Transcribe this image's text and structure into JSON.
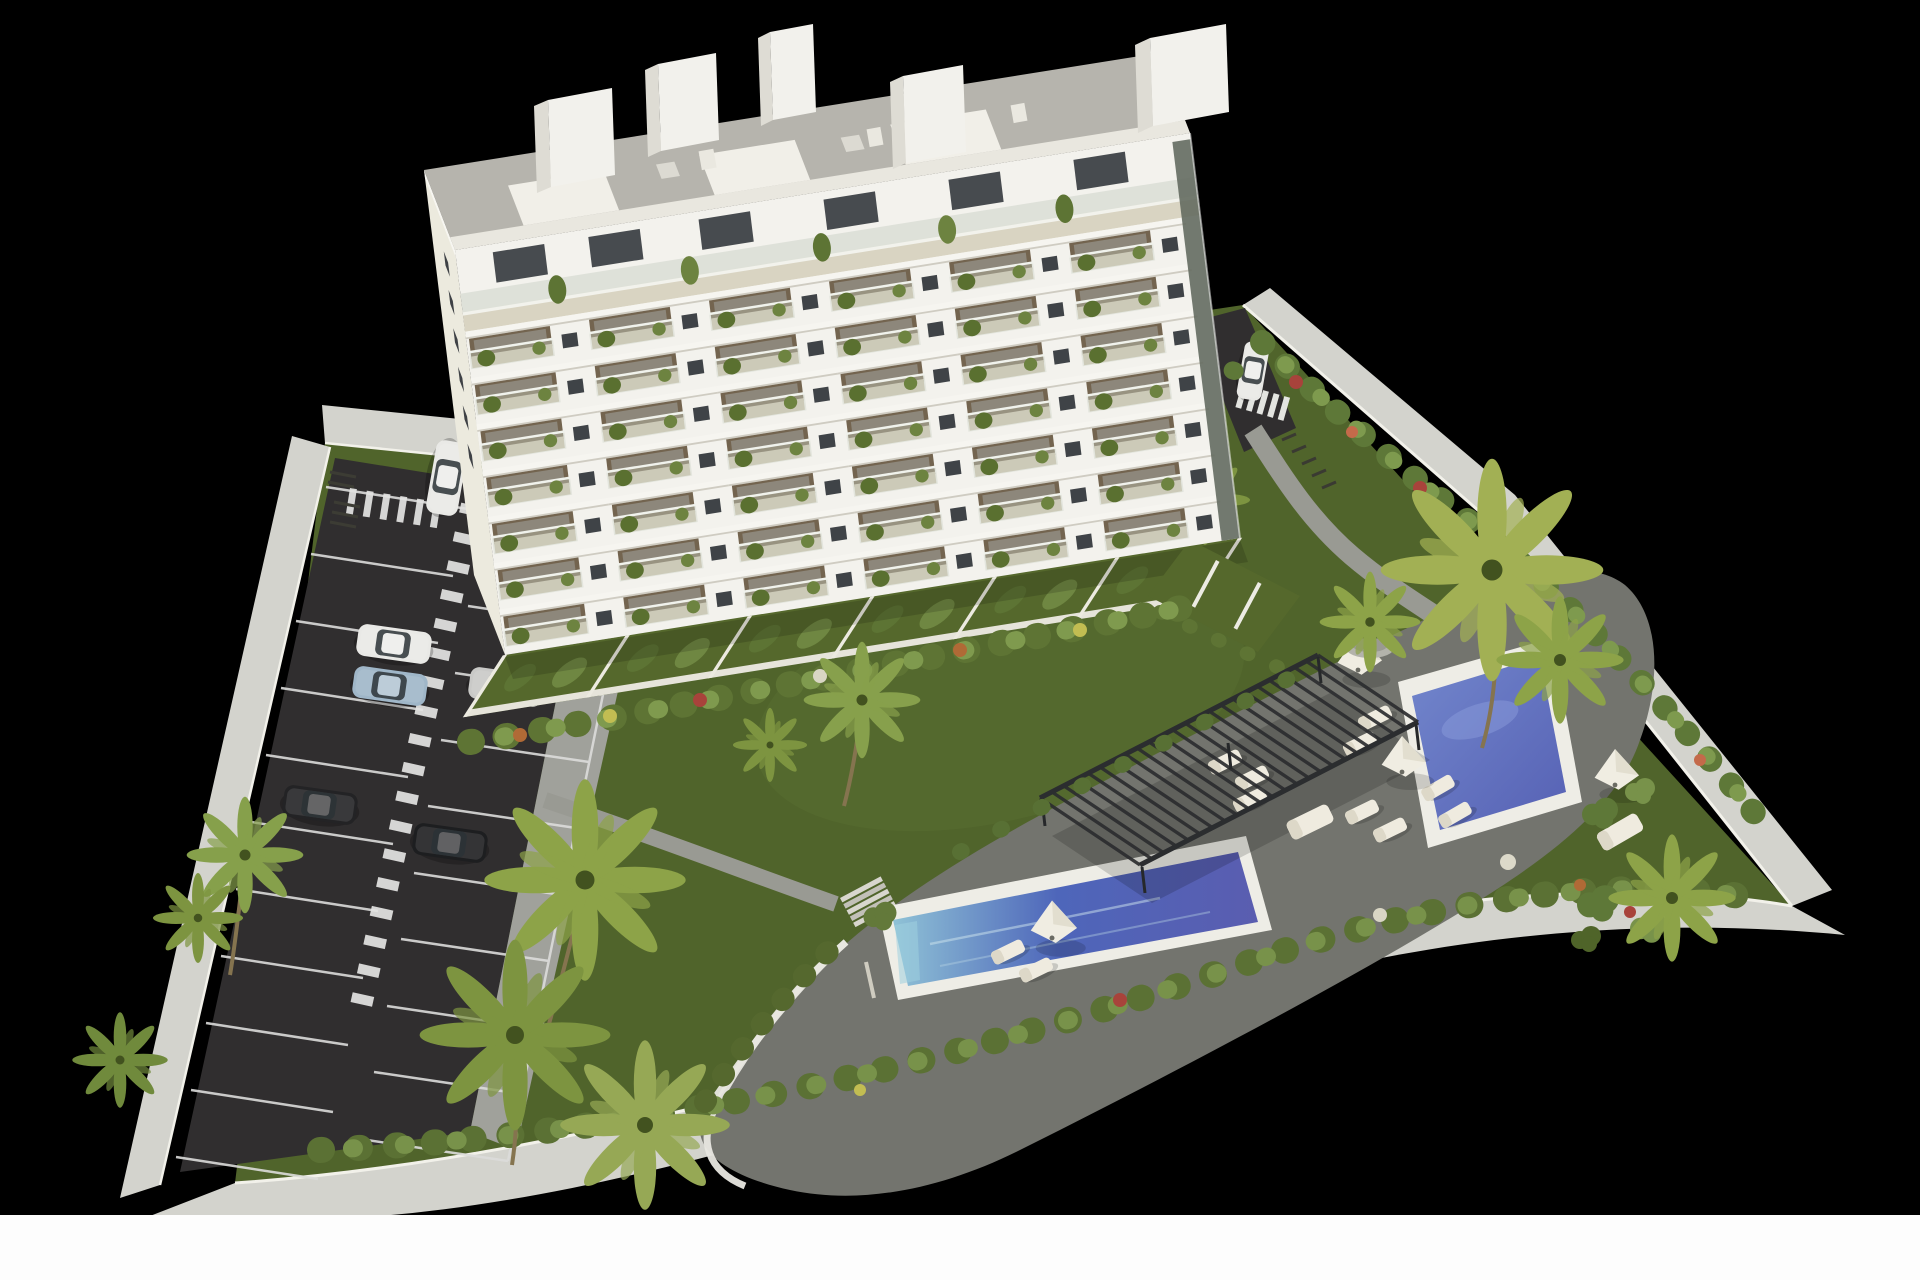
{
  "meta": {
    "type": "3d-architectural-render",
    "description": "Aerial 3D visualization of a white residential apartment block with landscaped gardens, two blue swimming pools, a slatted pergola sun deck and a surface parking lot, isolated on a black background with a white strip at the bottom edge"
  },
  "palette": {
    "background": "#000000",
    "foreground_band": "#fdfdfd",
    "grass": "#50642b",
    "grass_light": "#5d7333",
    "asphalt": "#302e2f",
    "parking_line": "#dcdcda",
    "wall": "#d3d3cd",
    "wall_top": "#f2f1ea",
    "building": "#f3f2ed",
    "building_shadow": "#e2e0d8",
    "roof": "#b6b4ad",
    "balcony_floor": "#cbc3ad",
    "balcony_interior": "#73644f",
    "window": "#3f4347",
    "terrace_wall": "#eceae0",
    "deck": "#73746e",
    "path": "#999a93",
    "pergola": "#2b2d2f",
    "pool_coping": "#eeede6",
    "pool_water_light": "#8fc2d6",
    "pool_water_deep": "#4e66ba",
    "pool_water_violet": "#5a5db0",
    "furniture": "#efebdf",
    "foliage": "#5e7434",
    "foliage_light": "#7f9a4e",
    "palm": "#8da348",
    "flower_red": "#a8433b",
    "flower_orange": "#b06a36",
    "flower_yellow": "#c2bd52",
    "car_white": "#e9e9e6",
    "car_black": "#1f2022",
    "car_blue": "#9fb6c8",
    "car_silver": "#c9c9c7"
  },
  "scene": {
    "building": {
      "kind": "white apartment block",
      "visible_floors": 9,
      "balcony_bays_per_floor": 6,
      "balconies": "glass balustrades with potted plants",
      "roof": "gravel flat roof with white stair towers"
    },
    "amenities": {
      "pools": 2,
      "pergola": 1,
      "sun_umbrellas": 5,
      "sun_loungers": 12,
      "deck": "grey stone sun terrace",
      "garden": "lawns, palm trees and flowering hedges"
    },
    "parking": {
      "surface_lot": true,
      "marked_stalls": true,
      "pedestrian_crosswalks": 3,
      "cars_visible": 8,
      "car_colors": [
        "white",
        "black",
        "white",
        "light blue",
        "silver",
        "black",
        "black",
        "white"
      ],
      "bike_racks": 2
    },
    "perimeter": "white boundary walls on all sides"
  }
}
